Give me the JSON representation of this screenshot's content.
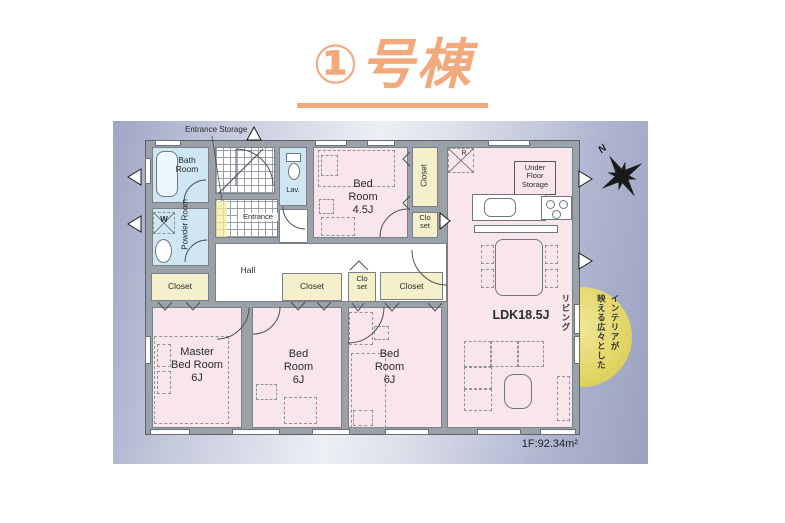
{
  "title": "①号棟",
  "colors": {
    "title_orange": "#f2a97c",
    "room_pink": "#f9e6ec",
    "water_blue": "#cfe7f3",
    "closet_cream": "#f6efcb",
    "wall_gray": "#9ba1a9",
    "callout_yellow": "#dfd058",
    "panel_blue": "#a6adc8"
  },
  "plan": {
    "labels": {
      "entrance_storage": "Entrance Storage",
      "bath": "Bath\nRoom",
      "powder": "Powder Room",
      "washer": "W",
      "lav": "Lav.",
      "entrance": "Entrance",
      "hall": "Hall",
      "bed45": "Bed\nRoom\n4.5J",
      "closet": "Closet",
      "closet_small": "Clo\nset",
      "fridge": "R",
      "under_floor_storage": "Under\nFloor\nStorage",
      "ldk": "LDK18.5J",
      "master": "Master\nBed Room\n6J",
      "bed6": "Bed\nRoom\n6J",
      "area": "1F:92.34m²",
      "north": "N"
    },
    "callout_lines": [
      "インテリアが",
      "映える広々とした",
      "リビング"
    ]
  }
}
